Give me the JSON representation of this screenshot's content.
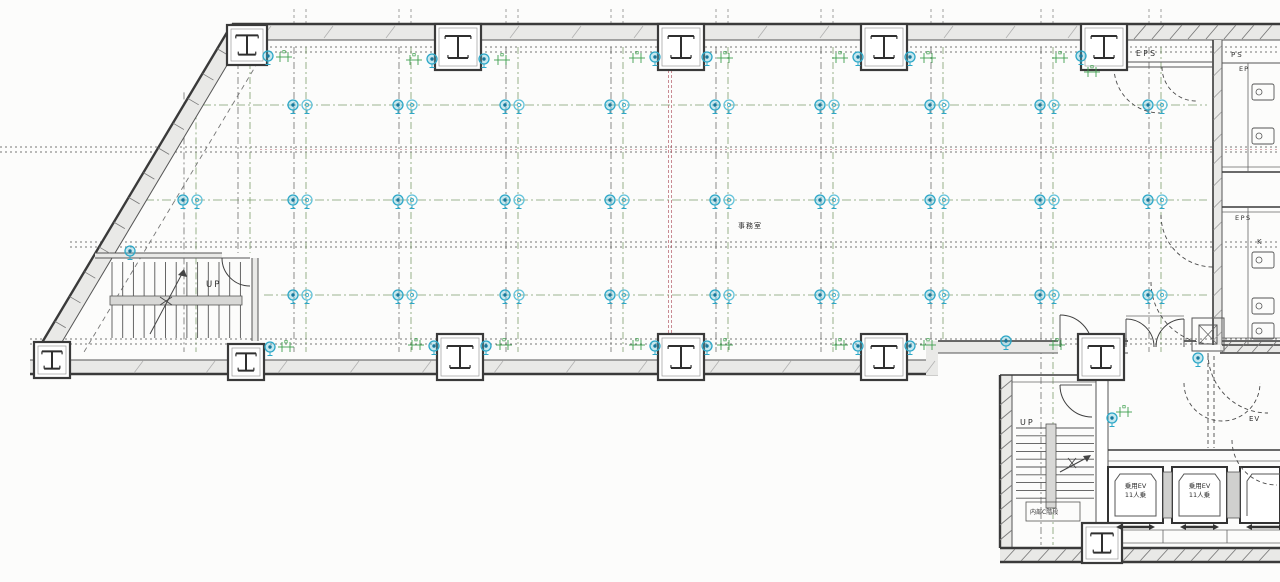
{
  "labels": {
    "room": "事務室",
    "eps_top": "EPS",
    "ps": "PS",
    "ep": "EP",
    "eps_mid": "EPS",
    "k": "K",
    "up_main": "UP",
    "up_annex": "UP",
    "annex_stairs": "内部C階段",
    "ev1_line1": "乗用EV",
    "ev1_line2": "11人乗",
    "ev2_line1": "乗用EV",
    "ev2_line2": "11人乗",
    "ev_hall": "EV"
  },
  "colors": {
    "line": "#3f3f3f",
    "wall_fill": "#e9e9e7",
    "grid": "#6e6e6e",
    "grid_green": "#7d9c6e",
    "maroon": "#b25563",
    "cyan": "#2da7c7",
    "cyan_dark": "#16789d",
    "cyan_light": "#62c2da",
    "green": "#3fa04e"
  },
  "grid": {
    "vertical_xs": [
      190,
      300,
      405,
      512,
      617,
      722,
      827,
      937,
      1047,
      1155
    ],
    "extra_vertical_xs": [
      244
    ],
    "pair_gap": 6,
    "band_ys": [
      47,
      147,
      242,
      339
    ],
    "maroon_vertical_x": 670,
    "annex_maroon_xs": [
      1099,
      1104
    ],
    "sprinkler_rows": [
      {
        "y": 105,
        "xs": [
          300,
          405,
          512,
          617,
          722,
          827,
          937,
          1047,
          1155
        ]
      },
      {
        "y": 200,
        "xs": [
          190,
          300,
          405,
          512,
          617,
          722,
          827,
          937,
          1047,
          1155
        ]
      },
      {
        "y": 295,
        "xs": [
          300,
          405,
          512,
          617,
          722,
          827,
          937,
          1047,
          1155
        ]
      }
    ]
  },
  "columns": {
    "top": [
      {
        "cx": 247,
        "cy": 45,
        "s": 40
      },
      {
        "cx": 458,
        "cy": 47,
        "s": 46
      },
      {
        "cx": 681,
        "cy": 47,
        "s": 46
      },
      {
        "cx": 884,
        "cy": 47,
        "s": 46
      },
      {
        "cx": 1104,
        "cy": 47,
        "s": 46
      }
    ],
    "bottom": [
      {
        "cx": 52,
        "cy": 360,
        "s": 36
      },
      {
        "cx": 246,
        "cy": 362,
        "s": 36
      },
      {
        "cx": 460,
        "cy": 357,
        "s": 46
      },
      {
        "cx": 681,
        "cy": 357,
        "s": 46
      },
      {
        "cx": 884,
        "cy": 357,
        "s": 46
      },
      {
        "cx": 1101,
        "cy": 357,
        "s": 46
      }
    ],
    "annex": [
      {
        "cx": 1102,
        "cy": 543,
        "s": 40
      }
    ]
  },
  "symbols": {
    "wall_sprinklers": [
      [
        432,
        59
      ],
      [
        484,
        59
      ],
      [
        268,
        56
      ],
      [
        655,
        57
      ],
      [
        707,
        57
      ],
      [
        858,
        57
      ],
      [
        910,
        57
      ],
      [
        1081,
        56
      ],
      [
        434,
        346
      ],
      [
        486,
        346
      ],
      [
        655,
        346
      ],
      [
        707,
        346
      ],
      [
        858,
        346
      ],
      [
        910,
        346
      ],
      [
        1006,
        341
      ],
      [
        270,
        347
      ],
      [
        130,
        251
      ],
      [
        1198,
        358
      ],
      [
        1112,
        418
      ]
    ],
    "green_markers": [
      [
        414,
        60
      ],
      [
        502,
        60
      ],
      [
        637,
        58
      ],
      [
        725,
        58
      ],
      [
        840,
        58
      ],
      [
        928,
        58
      ],
      [
        1060,
        58
      ],
      [
        1092,
        72
      ],
      [
        284,
        57
      ],
      [
        416,
        345
      ],
      [
        504,
        345
      ],
      [
        637,
        345
      ],
      [
        725,
        345
      ],
      [
        840,
        345
      ],
      [
        928,
        345
      ],
      [
        1057,
        345
      ],
      [
        286,
        347
      ],
      [
        1124,
        412
      ]
    ]
  }
}
